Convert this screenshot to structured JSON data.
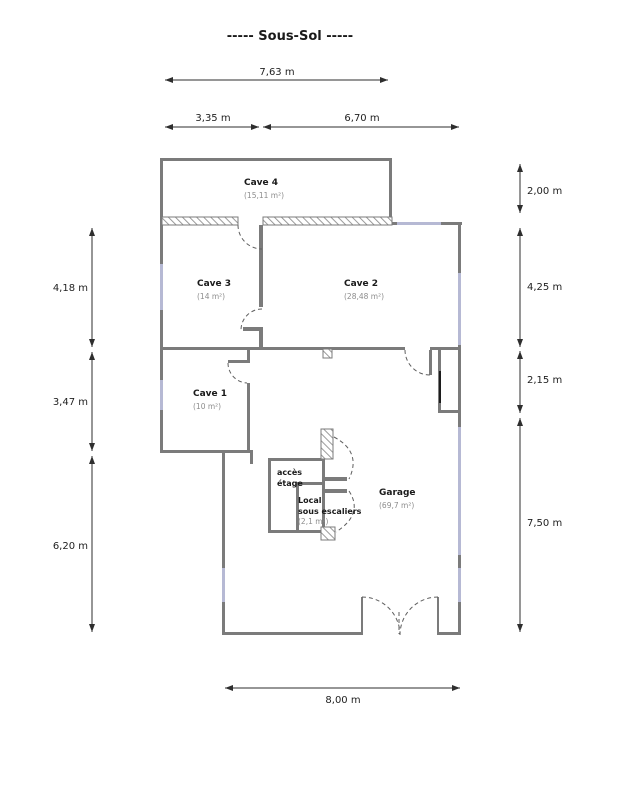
{
  "title": "-----  Sous-Sol  -----",
  "rooms": {
    "cave4": {
      "name": "Cave 4",
      "area": "(15,11 m²)"
    },
    "cave3": {
      "name": "Cave 3",
      "area": "(14 m²)"
    },
    "cave2": {
      "name": "Cave 2",
      "area": "(28,48 m²)"
    },
    "cave1": {
      "name": "Cave 1",
      "area": "(10 m²)"
    },
    "garage": {
      "name": "Garage",
      "area": "(69,7 m²)"
    },
    "local": {
      "line1": "Local",
      "line2": "sous escaliers",
      "area": "(2,1 m²)"
    },
    "acces": {
      "line1": "accès",
      "line2": "étage"
    }
  },
  "dimensions": {
    "top_total": "7,63 m",
    "top_left": "3,35 m",
    "top_right": "6,70 m",
    "left": [
      "4,18 m",
      "3,47 m",
      "6,20 m"
    ],
    "right": [
      "2,00 m",
      "4,25 m",
      "2,15 m",
      "7,50 m"
    ],
    "bottom": "8,00 m"
  },
  "colors": {
    "wall": "#7b7b7b",
    "window": "#b6b9d4",
    "hatch_stroke": "#909090",
    "dimension_line": "#2e2e2e",
    "room_name_text": "#1a1a1a",
    "room_area_text": "#8d8d8d",
    "door_arc": "#5f5f5f",
    "background": "#ffffff"
  }
}
